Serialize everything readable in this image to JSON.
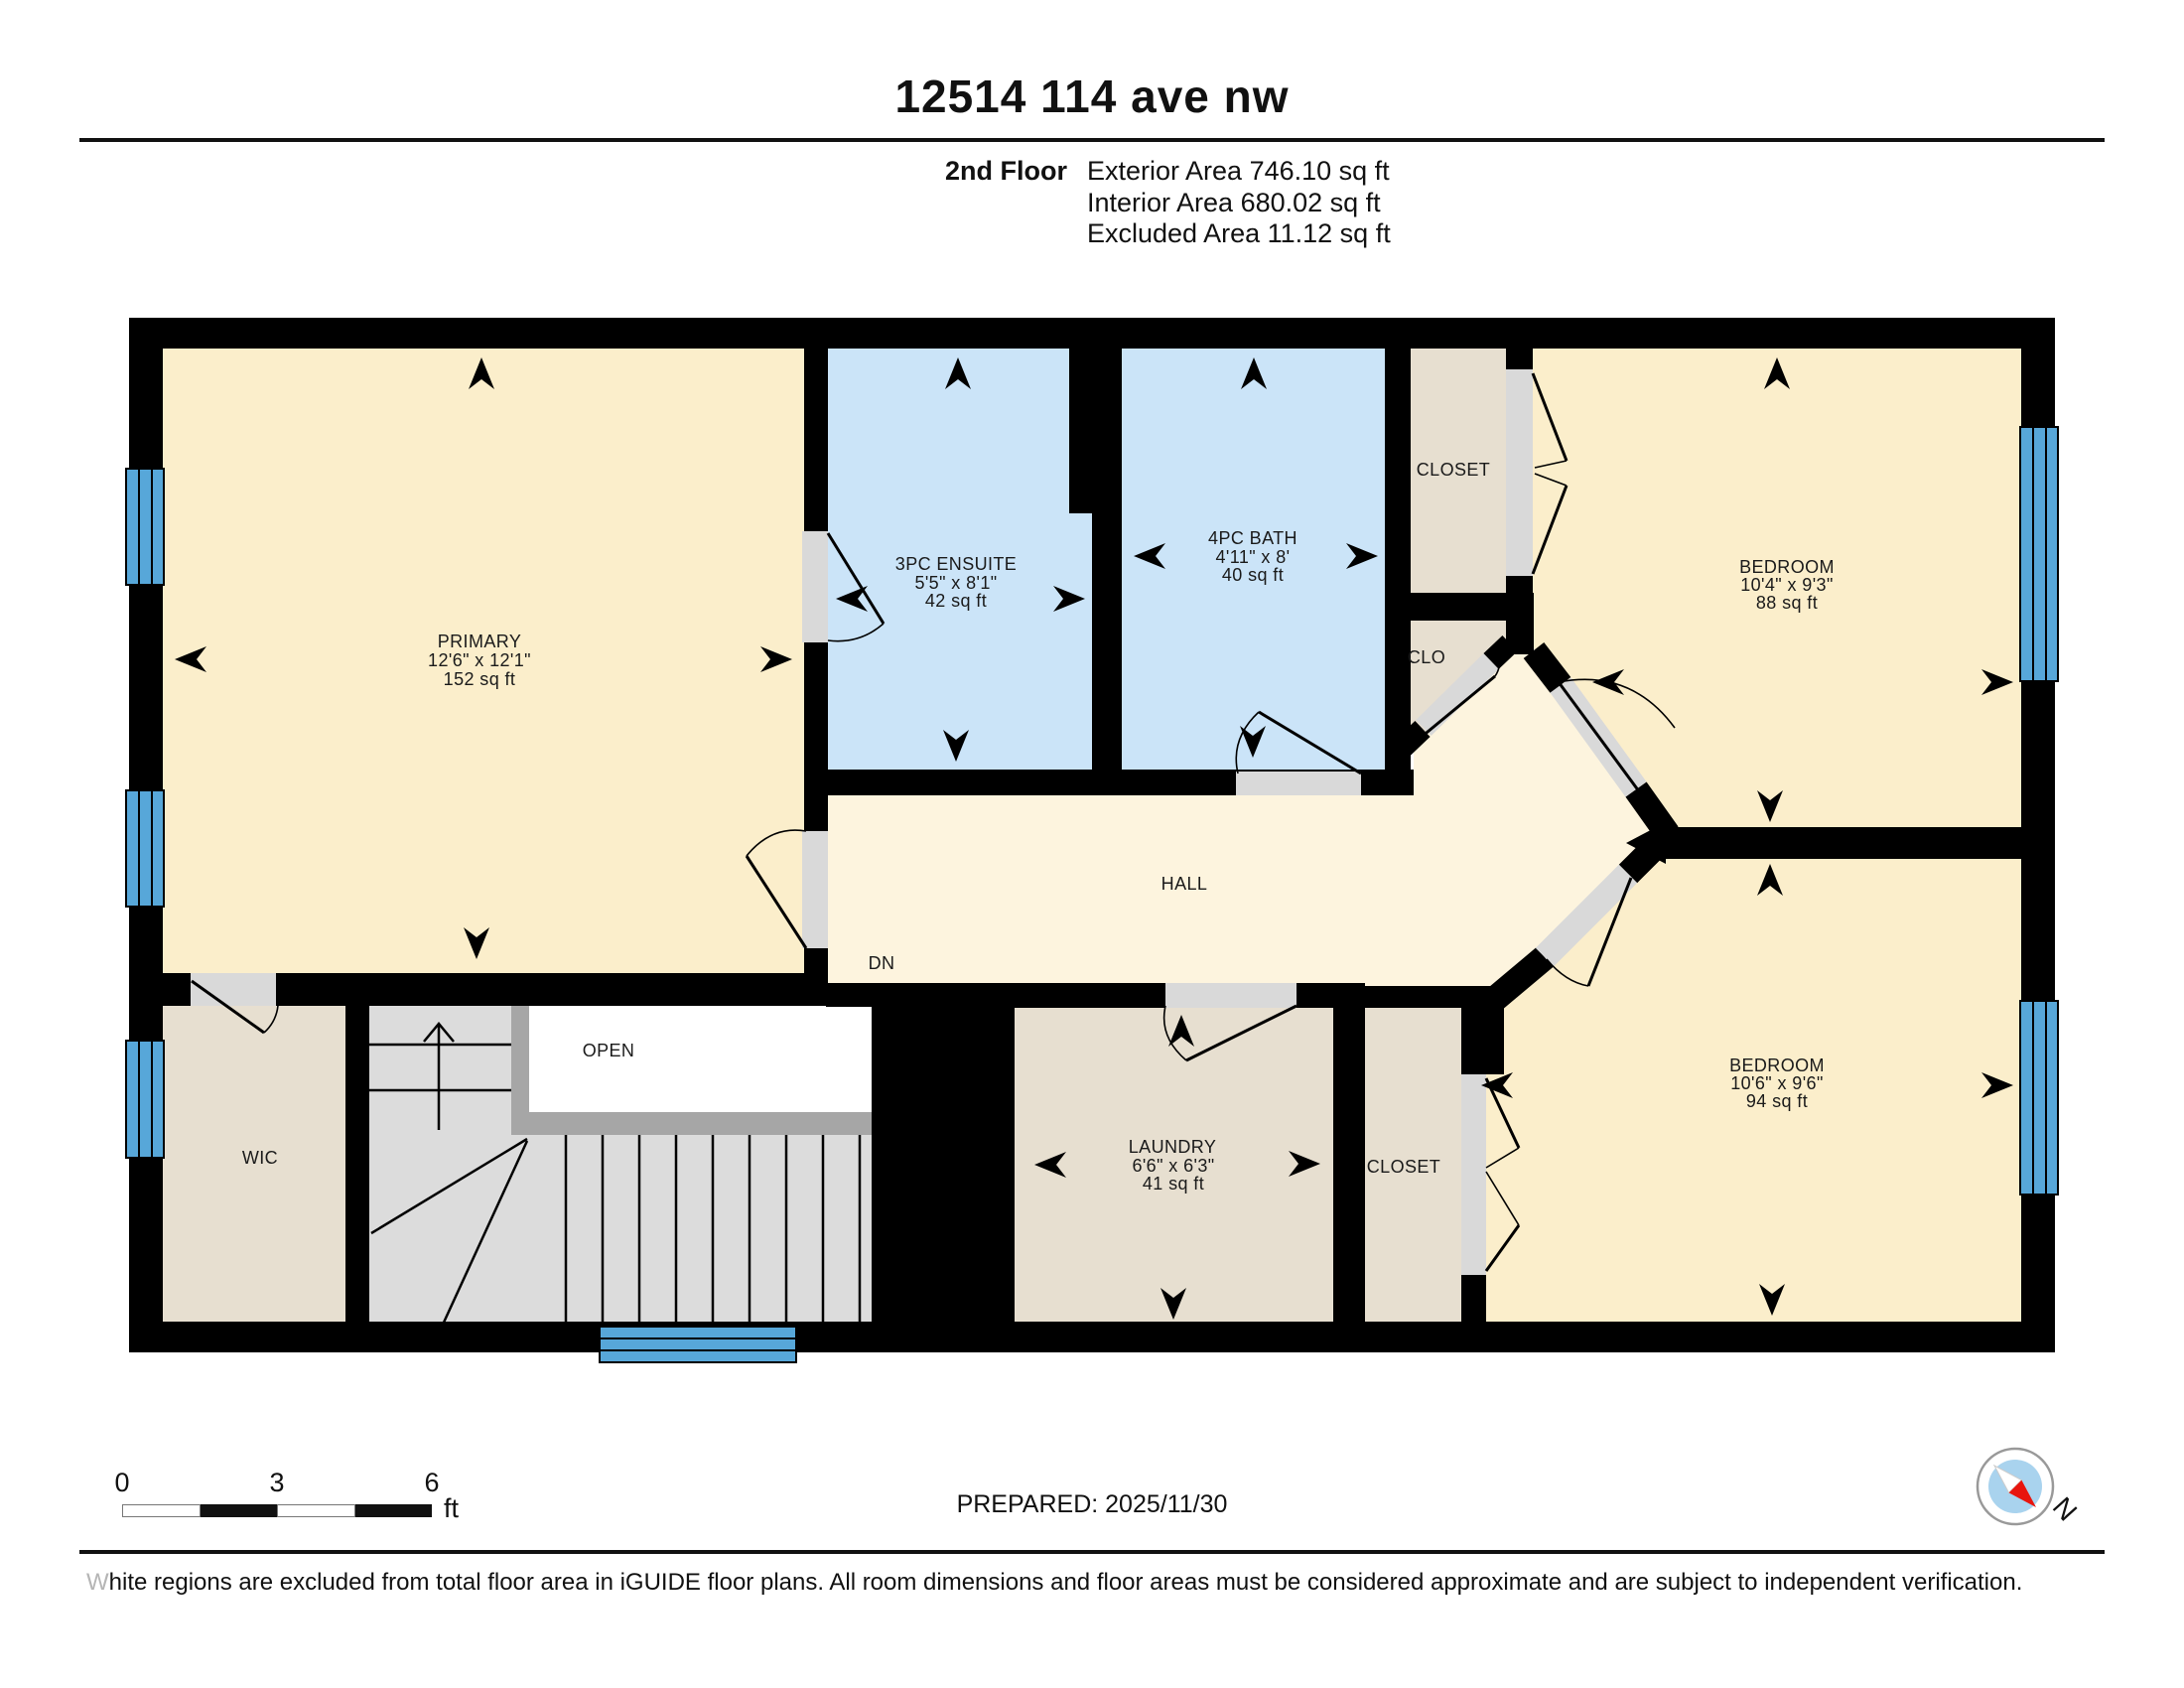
{
  "title": "12514 114 ave nw",
  "floor_info": {
    "floor_label": "2nd Floor",
    "areas": [
      "Exterior Area 746.10 sq ft",
      "Interior Area 680.02 sq ft",
      "Excluded Area 11.12 sq ft"
    ]
  },
  "rooms": {
    "primary": {
      "name": "PRIMARY",
      "dims": "12'6\" x 12'1\"",
      "area": "152 sq ft"
    },
    "ensuite": {
      "name": "3PC ENSUITE",
      "dims": "5'5\" x 8'1\"",
      "area": "42 sq ft"
    },
    "bath": {
      "name": "4PC BATH",
      "dims": "4'11\" x 8'",
      "area": "40 sq ft"
    },
    "bedroom_upper": {
      "name": "BEDROOM",
      "dims": "10'4\" x 9'3\"",
      "area": "88 sq ft"
    },
    "bedroom_lower": {
      "name": "BEDROOM",
      "dims": "10'6\" x 9'6\"",
      "area": "94 sq ft"
    },
    "laundry": {
      "name": "LAUNDRY",
      "dims": "6'6\" x 6'3\"",
      "area": "41 sq ft"
    },
    "closet_upper": {
      "name": "CLOSET"
    },
    "clo": {
      "name": "CLO"
    },
    "closet_lower": {
      "name": "CLOSET"
    },
    "hall": {
      "name": "HALL"
    },
    "wic": {
      "name": "WIC"
    },
    "open": {
      "name": "OPEN"
    },
    "stairs_direction": "DN"
  },
  "scale_bar": {
    "ticks": [
      "0",
      "3",
      "6"
    ],
    "unit": "ft"
  },
  "prepared": "PREPARED: 2025/11/30",
  "compass": {
    "north_label": "N"
  },
  "footer": {
    "lead": "W",
    "text": "hite regions are excluded from total floor area in iGUIDE floor plans. All room dimensions and floor areas must be considered approximate and are subject to independent verification."
  },
  "colors": {
    "room_fill": "#fbeecb",
    "hall_fill": "#fdf4de",
    "wet_room_fill": "#cbe4f8",
    "closet_fill": "#e7dfd0",
    "window_blue": "#57a7d9",
    "door_gray": "#d9d9d9",
    "stair_gray": "#dcdcdc",
    "stringer_gray": "#a6a6a6",
    "wall": "#000000",
    "compass_red": "#e8150e",
    "compass_blue": "#a9d3ee"
  }
}
